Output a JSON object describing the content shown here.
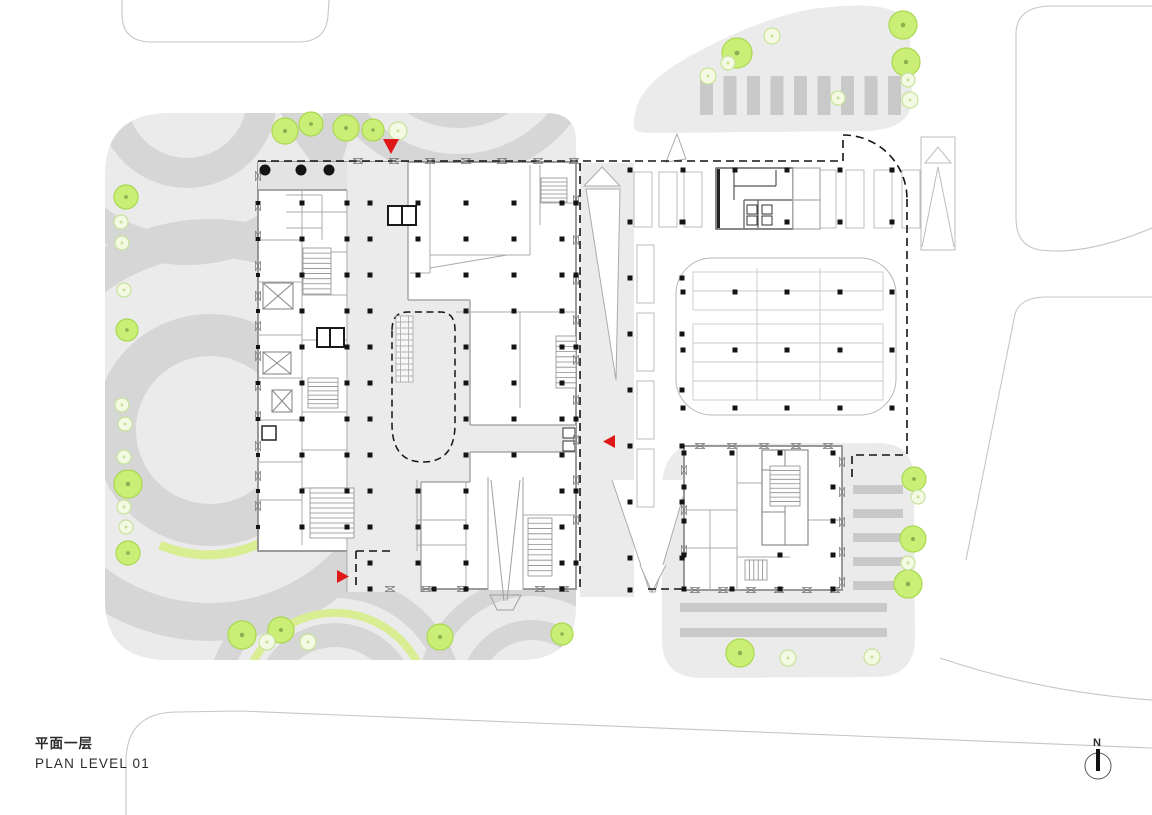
{
  "meta": {
    "title_cn": "平面一层",
    "title_en": "PLAN LEVEL 01",
    "north_label": "N",
    "drawing_type": "architectural site / floor plan, level 01"
  },
  "colors": {
    "site_gray": "#ebebeb",
    "court_gray": "#e3e3e3",
    "arc_gray": "#d6d6d6",
    "stripe_gray": "#c9c9c9",
    "wall": "#8f8f8f",
    "partition": "#ababab",
    "column": "#141414",
    "dash": "#141414",
    "road": "#c6c6c6",
    "tree_fill": "#cbef76",
    "tree_stroke": "#a9d94f",
    "tree_dot": "#8fae52",
    "tree_pale_fill": "#f3f9e3",
    "tree_pale_stroke": "#c7e39b",
    "accent_red": "#e01717",
    "green_arc": "#d9ee92"
  },
  "markers": [
    {
      "id": "entrance-arrow-north",
      "dir": "down",
      "x": 391,
      "y": 139
    },
    {
      "id": "entrance-arrow-southwest",
      "dir": "right",
      "x": 337,
      "y": 570
    },
    {
      "id": "entrance-arrow-east",
      "dir": "left",
      "x": 615,
      "y": 435
    }
  ],
  "trees": {
    "bright": [
      [
        285,
        131,
        13
      ],
      [
        311,
        124,
        12
      ],
      [
        346,
        128,
        13
      ],
      [
        373,
        130,
        11
      ],
      [
        126,
        197,
        12
      ],
      [
        127,
        330,
        11
      ],
      [
        128,
        484,
        14
      ],
      [
        128,
        553,
        12
      ],
      [
        242,
        635,
        14
      ],
      [
        281,
        630,
        13
      ],
      [
        440,
        637,
        13
      ],
      [
        562,
        634,
        11
      ],
      [
        737,
        53,
        15
      ],
      [
        903,
        25,
        14
      ],
      [
        906,
        62,
        14
      ],
      [
        914,
        479,
        12
      ],
      [
        913,
        539,
        13
      ],
      [
        908,
        584,
        14
      ],
      [
        740,
        653,
        14
      ]
    ],
    "pale": [
      [
        398,
        131,
        9
      ],
      [
        121,
        222,
        7
      ],
      [
        122,
        243,
        7
      ],
      [
        124,
        290,
        7
      ],
      [
        122,
        405,
        7
      ],
      [
        125,
        424,
        7
      ],
      [
        124,
        457,
        7
      ],
      [
        124,
        507,
        7
      ],
      [
        126,
        527,
        7
      ],
      [
        267,
        642,
        8
      ],
      [
        308,
        642,
        8
      ],
      [
        708,
        76,
        8
      ],
      [
        728,
        63,
        7
      ],
      [
        772,
        36,
        8
      ],
      [
        908,
        80,
        7
      ],
      [
        910,
        100,
        8
      ],
      [
        838,
        98,
        7
      ],
      [
        918,
        497,
        7
      ],
      [
        908,
        563,
        7
      ],
      [
        788,
        658,
        8
      ],
      [
        872,
        657,
        8
      ]
    ]
  },
  "round_columns": [
    [
      265,
      170
    ],
    [
      301,
      170
    ],
    [
      329,
      170
    ]
  ],
  "column_groups": [
    {
      "name": "main-east",
      "xs": [
        370,
        418,
        466,
        514,
        562
      ],
      "ys": [
        203,
        239,
        275,
        311,
        347,
        383,
        419,
        455,
        491,
        527,
        563
      ],
      "size": 5,
      "skip": [
        "418,311",
        "418,347",
        "418,383",
        "418,419",
        "418,455",
        "514,491",
        "514,527",
        "514,563"
      ]
    },
    {
      "name": "main-west",
      "xs": [
        302,
        347
      ],
      "ys": [
        203,
        239,
        275,
        311,
        347,
        383,
        419,
        455,
        491,
        527
      ],
      "size": 5,
      "skip": []
    },
    {
      "name": "main-westwall",
      "xs": [
        258
      ],
      "ys": [
        203,
        239,
        275,
        311,
        347,
        383,
        419,
        455,
        491,
        527
      ],
      "size": 4,
      "skip": []
    },
    {
      "name": "main-south",
      "xs": [
        370,
        434,
        466,
        562
      ],
      "ys": [
        589
      ],
      "size": 5,
      "skip": []
    },
    {
      "name": "main-eastwall",
      "xs": [
        576
      ],
      "ys": [
        203,
        275,
        347,
        419,
        491,
        563
      ],
      "size": 5,
      "skip": []
    },
    {
      "name": "driveway-west",
      "xs": [
        630
      ],
      "ys": [
        170,
        222,
        278,
        334,
        390,
        446,
        502,
        558,
        590
      ],
      "size": 5,
      "skip": []
    },
    {
      "name": "driveway-east",
      "xs": [
        682
      ],
      "ys": [
        222,
        278,
        334,
        390,
        446,
        502,
        558
      ],
      "size": 5,
      "skip": []
    },
    {
      "name": "north-lot-row1",
      "xs": [
        683,
        735,
        787,
        840,
        892
      ],
      "ys": [
        170
      ],
      "size": 5,
      "skip": []
    },
    {
      "name": "north-lot-row2",
      "xs": [
        683,
        787,
        840,
        892
      ],
      "ys": [
        222
      ],
      "size": 5,
      "skip": []
    },
    {
      "name": "canopy-grid",
      "xs": [
        683,
        735,
        787,
        840,
        892
      ],
      "ys": [
        292,
        350,
        408
      ],
      "size": 5,
      "skip": []
    },
    {
      "name": "tower2-grid",
      "xs": [
        684,
        732,
        780,
        833
      ],
      "ys": [
        453,
        487,
        521,
        555,
        589
      ],
      "size": 5,
      "skip": [
        "732,487",
        "780,487",
        "732,521",
        "780,521",
        "732,555"
      ]
    }
  ],
  "stripes": [
    {
      "name": "north-lot-bays",
      "orient": "v",
      "x0": 700,
      "dx": 23.5,
      "n": 9,
      "w": 13,
      "y": 76,
      "h": 39,
      "clip": "clipTR"
    },
    {
      "name": "tower2-east-paving",
      "orient": "h",
      "y0": 485,
      "dy": 24,
      "n": 5,
      "h": 9,
      "x": 853,
      "w": 50,
      "clip": "clipBR"
    },
    {
      "name": "tower2-south-paving",
      "orient": "h",
      "y0": 603,
      "dy": 25,
      "n": 2,
      "h": 9,
      "x": 680,
      "w": 207,
      "clip": "clipBR"
    }
  ],
  "stalls": [
    {
      "name": "driveway-stalls",
      "x0": 637,
      "y0": 245,
      "dx": 0,
      "dy": 68,
      "n": 4,
      "w": 17,
      "h": 58
    },
    {
      "name": "north-lot-stalls-west",
      "x0": 634,
      "y0": 172,
      "dx": 25,
      "dy": 0,
      "n": 3,
      "w": 18,
      "h": 55
    },
    {
      "name": "north-lot-stalls-east",
      "x0": 818,
      "y0": 170,
      "dx": 28,
      "dy": 0,
      "n": 4,
      "w": 18,
      "h": 58
    }
  ],
  "canopy_rows": {
    "x": 693,
    "w": 190,
    "h": 19,
    "ys": [
      272,
      291,
      324,
      343,
      362,
      381
    ],
    "dividers": [
      757,
      820
    ],
    "top": 268,
    "bottom": 400
  },
  "stairs": [
    {
      "x": 303,
      "y": 248,
      "w": 28,
      "h": 46,
      "n": 9,
      "orient": "h"
    },
    {
      "x": 308,
      "y": 378,
      "w": 30,
      "h": 30,
      "n": 7,
      "orient": "h"
    },
    {
      "x": 310,
      "y": 488,
      "w": 44,
      "h": 50,
      "n": 10,
      "orient": "h"
    },
    {
      "x": 541,
      "y": 178,
      "w": 26,
      "h": 24,
      "n": 6,
      "orient": "h"
    },
    {
      "x": 556,
      "y": 336,
      "w": 20,
      "h": 52,
      "n": 10,
      "orient": "h"
    },
    {
      "x": 528,
      "y": 518,
      "w": 24,
      "h": 58,
      "n": 11,
      "orient": "h"
    },
    {
      "x": 770,
      "y": 466,
      "w": 30,
      "h": 40,
      "n": 9,
      "orient": "h"
    },
    {
      "x": 745,
      "y": 560,
      "w": 22,
      "h": 20,
      "n": 5,
      "orient": "v"
    }
  ],
  "bowties": [
    {
      "x": 258,
      "y": 176,
      "dx": 0,
      "dy": 30,
      "n": 12,
      "vertical": true
    },
    {
      "x": 358,
      "y": 161,
      "dx": 36,
      "dy": 0,
      "n": 7,
      "vertical": false
    },
    {
      "x": 390,
      "y": 589,
      "dx": 36,
      "dy": 0,
      "n": 3,
      "vertical": false
    },
    {
      "x": 540,
      "y": 589,
      "dx": 24,
      "dy": 0,
      "n": 2,
      "vertical": false
    },
    {
      "x": 576,
      "y": 200,
      "dx": 0,
      "dy": 40,
      "n": 9,
      "vertical": true
    },
    {
      "x": 700,
      "y": 446,
      "dx": 32,
      "dy": 0,
      "n": 5,
      "vertical": false
    },
    {
      "x": 695,
      "y": 590,
      "dx": 28,
      "dy": 0,
      "n": 6,
      "vertical": false
    },
    {
      "x": 842,
      "y": 462,
      "dx": 0,
      "dy": 30,
      "n": 5,
      "vertical": true
    },
    {
      "x": 684,
      "y": 470,
      "dx": 0,
      "dy": 40,
      "n": 3,
      "vertical": true
    }
  ]
}
